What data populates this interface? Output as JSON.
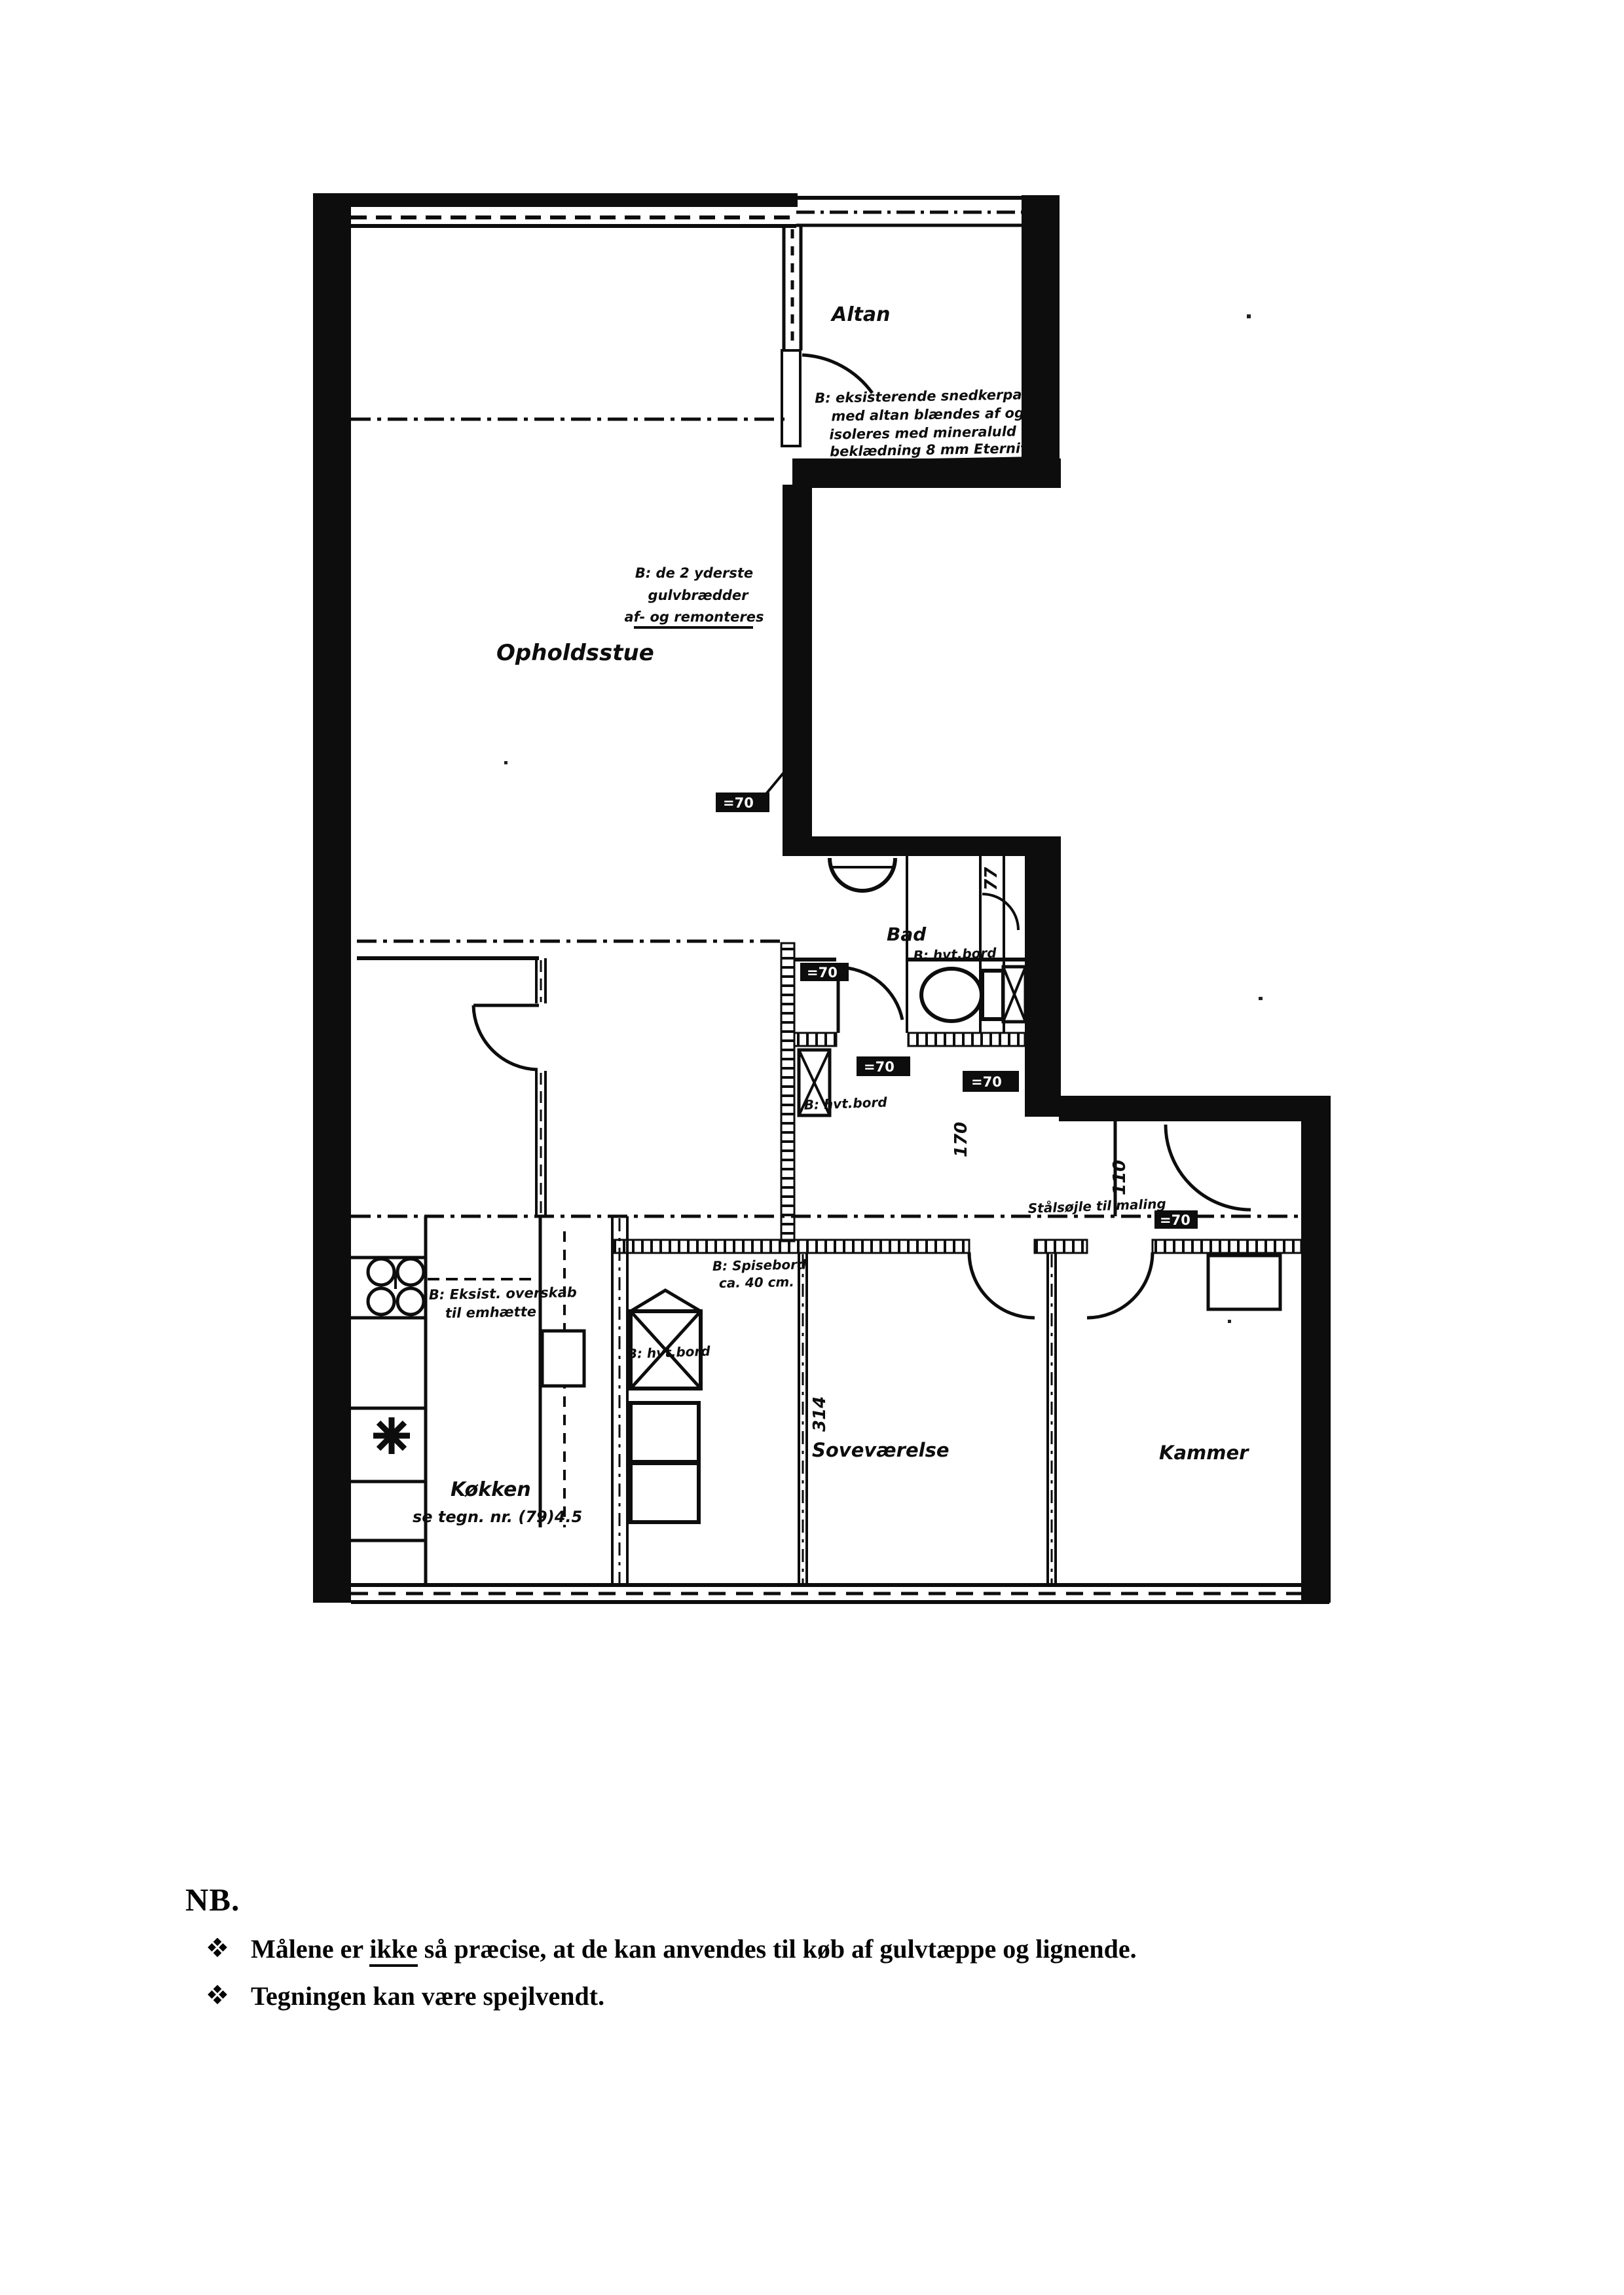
{
  "ink": "#0d0d0d",
  "plan": {
    "rooms": {
      "altan": "Altan",
      "opholdsstue": "Opholdsstue",
      "bad": "Bad",
      "koekken": "Køkken",
      "koekken_sub": "se tegn. nr. (79)4.5",
      "sovevaerelse": "Soveværelse",
      "kammer": "Kammer"
    },
    "annotations": {
      "balcony_note": {
        "lines": [
          "B: eksisterende snedkerparti",
          "med altan blændes af og",
          "isoleres med mineraluld -",
          "beklædning 8 mm Eternit"
        ]
      },
      "floor_note": {
        "lines": [
          "B: de 2 yderste",
          "gulvbrædder",
          "af- og remonteres"
        ]
      },
      "cabinet_notes": [
        "B: hvt.bord",
        "B: hvt.bord",
        "B: hvt.bord"
      ],
      "bedroom_note": {
        "lines": [
          "B: Spisebord",
          "ca. 40 cm."
        ]
      },
      "kitchen_note": {
        "lines": [
          "B: Eksist. overskab",
          "til emhætte"
        ]
      },
      "column_note": "Stålsøjle til maling"
    },
    "dimensions": {
      "shaft": "77",
      "hall": "170",
      "entry": "110",
      "bedroom": "314"
    },
    "dim_tags": [
      "=70",
      "=70",
      "=70",
      "=70",
      "=70"
    ]
  },
  "note": {
    "heading": "NB.",
    "item1_before": "Målene er ",
    "item1_underlined": "ikke",
    "item1_after": " så præcise, at de kan anvendes til køb af gulvtæppe og lignende.",
    "item2": "Tegningen kan være spejlvendt."
  }
}
